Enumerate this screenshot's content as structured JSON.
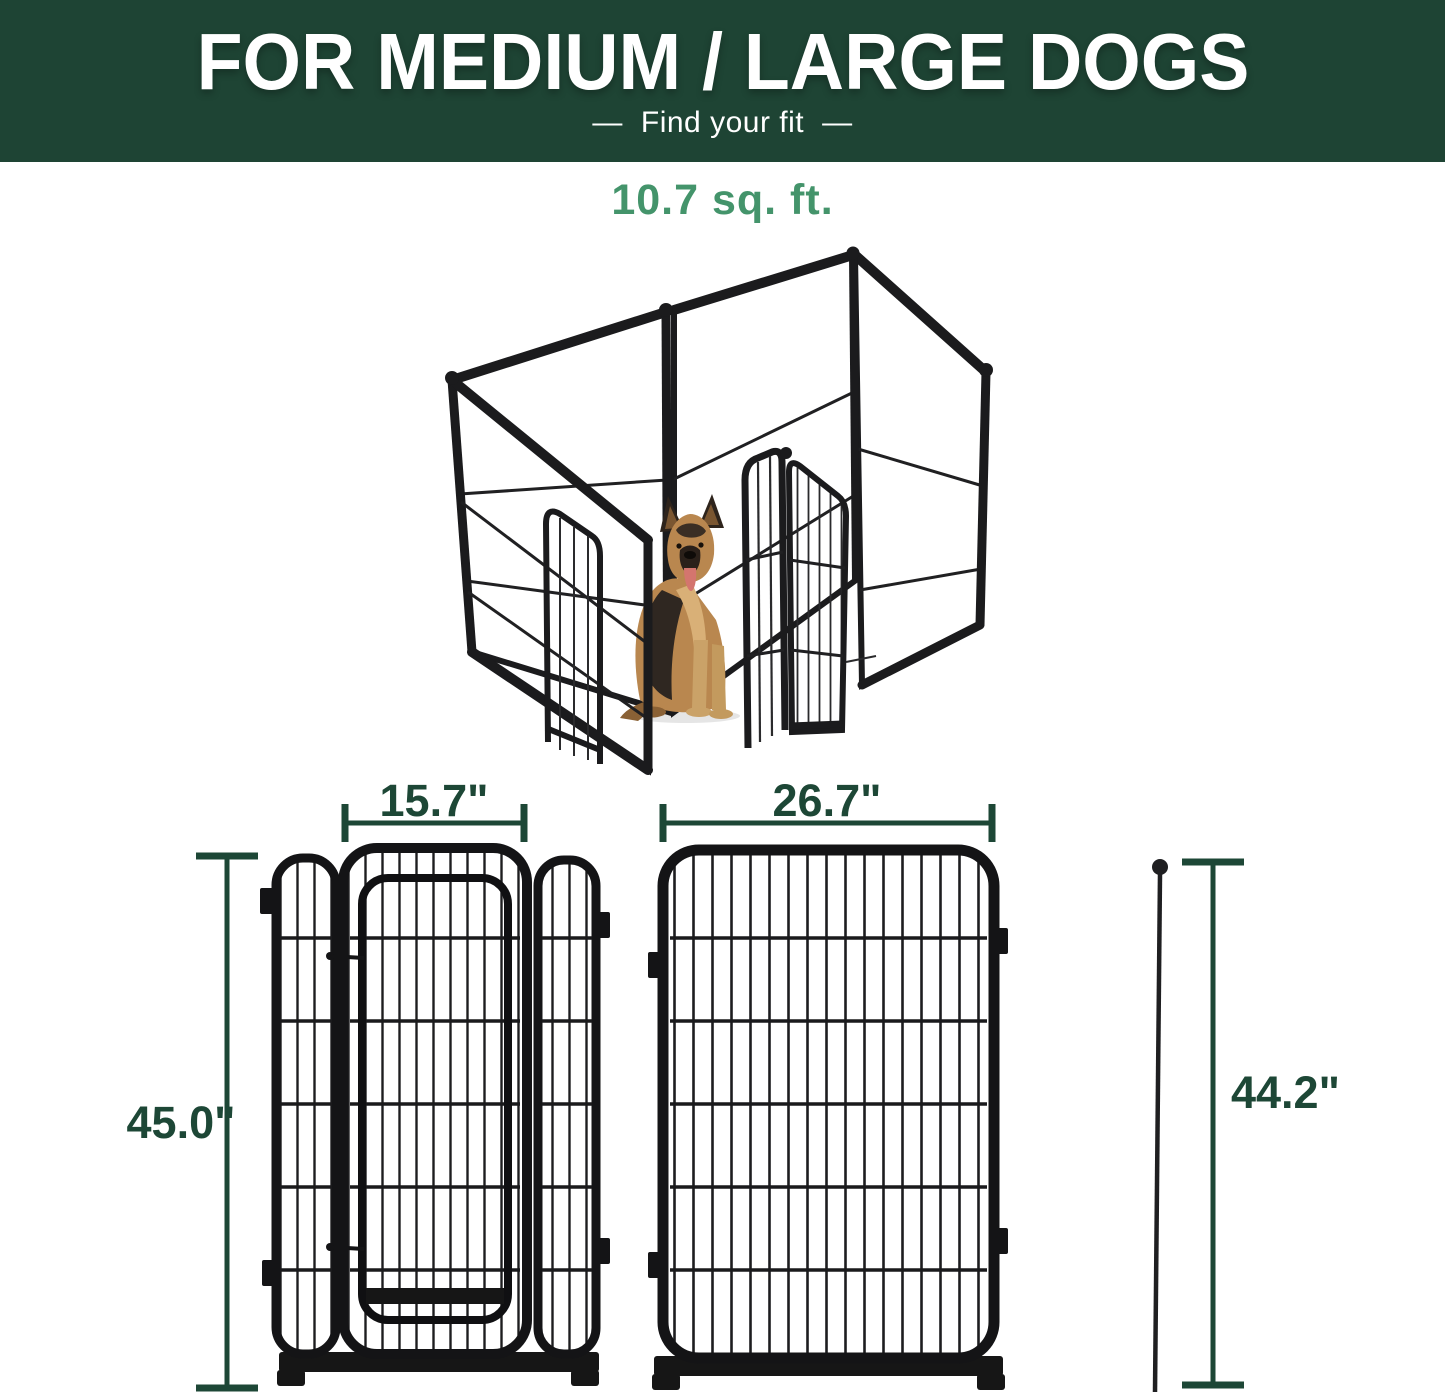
{
  "header": {
    "title": "FOR MEDIUM / LARGE DOGS",
    "subtitle": "Find your fit",
    "dash_left": "—",
    "dash_right": "—"
  },
  "product": {
    "area_label": "10.7 sq. ft."
  },
  "dimensions": {
    "door_section_width": "15.7\"",
    "door_section_height": "45.0\"",
    "panel_width": "26.7\"",
    "panel_side_height": "44.2\""
  },
  "colors": {
    "header_background": "#1e4434",
    "accent_green": "#44946b",
    "dimension_green": "#1d4736",
    "pen_black": "#1b1b1d",
    "dog_tan": "#b9874f"
  }
}
